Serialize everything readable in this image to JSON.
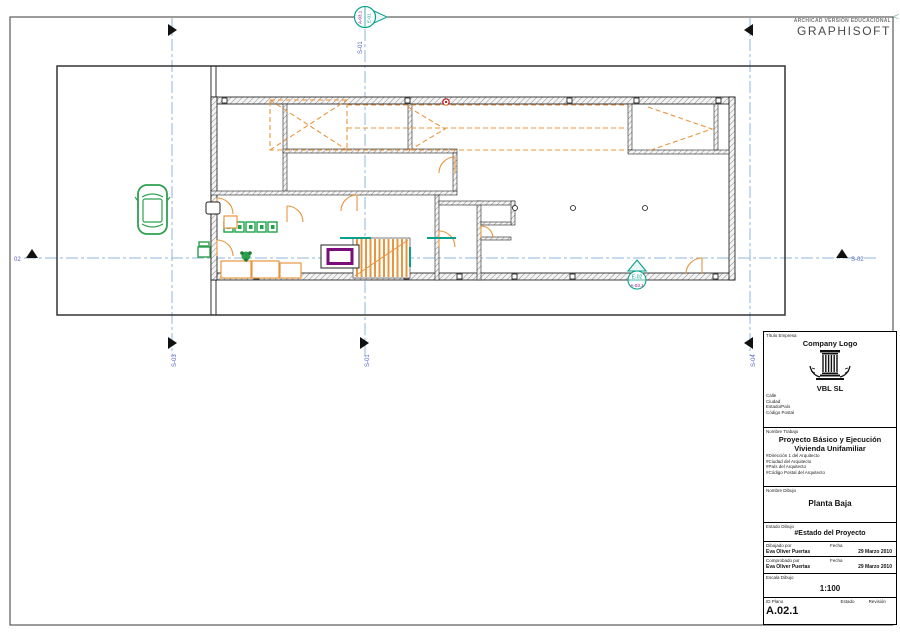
{
  "header": {
    "educational": "ARCHICAD VERSIÓN EDUCACIONAL",
    "brand": "GRAPHISOFT",
    "collapse": "<"
  },
  "markers": {
    "s01": "S-01",
    "s02": "S-02",
    "s02_left": "02",
    "s03": "S-03",
    "s04": "S-04",
    "elev_top_left": "A-03.1",
    "elev_top_right": "E-01",
    "elev_plan_top": "E-02",
    "elev_plan_bottom": "A-03.1"
  },
  "titleblock": {
    "company_label": "Título Empresa",
    "company_logo": "Company Logo",
    "company_name": "VBL SL",
    "address": [
      "Calle",
      "Ciudad",
      "Estado/País",
      "Código Postal"
    ],
    "job_label": "Nombre Trabajo",
    "job_title1": "Proyecto Básico y Ejecución",
    "job_title2": "Vivienda Unifamiliar",
    "architect": [
      "#Dirección 1 del Arquitecto",
      "#Ciudad del Arquitecto",
      "#País del Arquitecto",
      "#Código Postal del Arquitecto"
    ],
    "drawing_label": "Nombre Dibujo",
    "drawing_name": "Planta Baja",
    "status_label": "Estado Dibujo",
    "status_value": "#Estado del Proyecto",
    "drawn_label": "Dibujado por",
    "drawn_by": "Eva Oliver Puertas",
    "checked_label": "Comprobado por",
    "checked_by": "Eva Oliver Puertas",
    "date_label": "Fecha",
    "drawn_date": "29 Marzo 2010",
    "checked_date": "29 Marzo 2010",
    "scale_label": "Escala Dibujo",
    "scale_value": "1:100",
    "id_label": "ID Plano",
    "id_value": "A.02.1",
    "estado_label": "Estado",
    "revision_label": "Revisión"
  },
  "colors": {
    "door_orange": "#E8953F",
    "marker_teal": "#0AA08C",
    "object_green": "#2DA04E",
    "table_purple": "#7A0D7A",
    "section_line_blue": "#8FB4DD",
    "section_label_blue": "#5560C8",
    "alert_red": "#CC1111"
  }
}
